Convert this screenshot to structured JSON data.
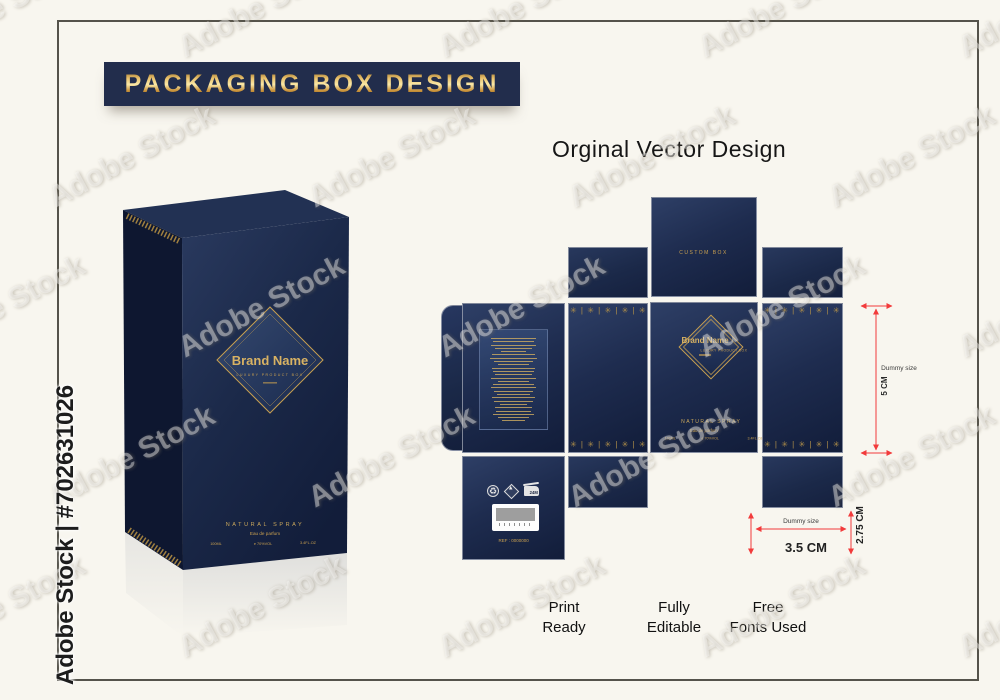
{
  "page": {
    "watermark": "Adobe Stock",
    "credit": "Adobe Stock | #702631026"
  },
  "banner": {
    "title": "PACKAGING BOX DESIGN"
  },
  "section": {
    "title": "Orginal Vector Design"
  },
  "product": {
    "brand": "Brand Name",
    "tagline": "LUXURY PRODUCT BOX",
    "natural_spray": "NATURAL SPRAY",
    "eau_de_parfum": "Eau de parfum",
    "volume_ml": "100ML",
    "volume_e": "e 70%VOL",
    "volume_floz": "3.4FL.OZ"
  },
  "dieline": {
    "top_panel_label": "CUSTOM BOX",
    "ref_label": "REF : 0000000",
    "ornament_unit": "✳ | ",
    "icons": {
      "recycle_glyph": "♻",
      "flammable_glyph": "▲",
      "period_after_opening_label": "24M"
    }
  },
  "dimensions": {
    "height_value": "5 CM",
    "height_note": "Dummy size",
    "width_value": "3.5 CM",
    "width_note": "Dummy size",
    "depth_value": "2.75 CM"
  },
  "features": [
    {
      "label": "Print\nReady"
    },
    {
      "label": "Fully\nEditable"
    },
    {
      "label": "Free\nFonts Used"
    }
  ],
  "colors": {
    "navy": "#1e2c4f",
    "gold": "#c9a050",
    "dimension_red": "#f23b3b",
    "background": "#f8f6ef"
  }
}
